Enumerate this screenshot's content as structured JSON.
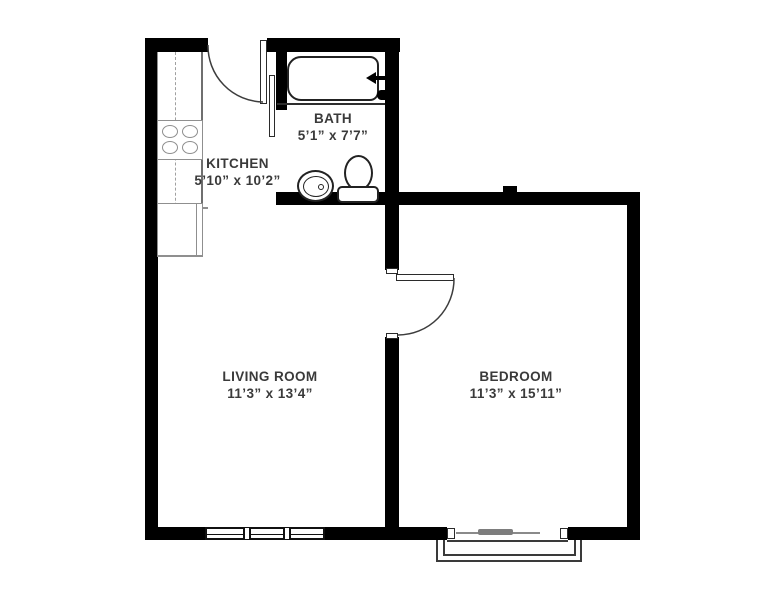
{
  "rooms": {
    "bath": {
      "name": "BATH",
      "dims": "5’1” x 7’7”"
    },
    "kitchen": {
      "name": "KITCHEN",
      "dims": "5’10” x 10’2”"
    },
    "living_room": {
      "name": "LIVING ROOM",
      "dims": "11’3” x 13’4”"
    },
    "bedroom": {
      "name": "BEDROOM",
      "dims": "11’3” x 15’11”"
    }
  },
  "fixtures": {
    "bath": [
      "bathtub",
      "tub-faucet",
      "toilet",
      "sink"
    ],
    "kitchen": [
      "counter",
      "stove-4-burners",
      "refrigerator"
    ],
    "doors": [
      "entry-door",
      "bath-door",
      "bedroom-door",
      "sliding-patio-door"
    ],
    "windows": [
      "living-room-window",
      "balcony-frame"
    ]
  },
  "colors": {
    "wall": "#000000",
    "fixture_line": "#222222",
    "kitchen_line": "#8f8f8f",
    "text": "#3a3a3a",
    "slider_gray": "#7d7d7d",
    "background": "#ffffff"
  }
}
